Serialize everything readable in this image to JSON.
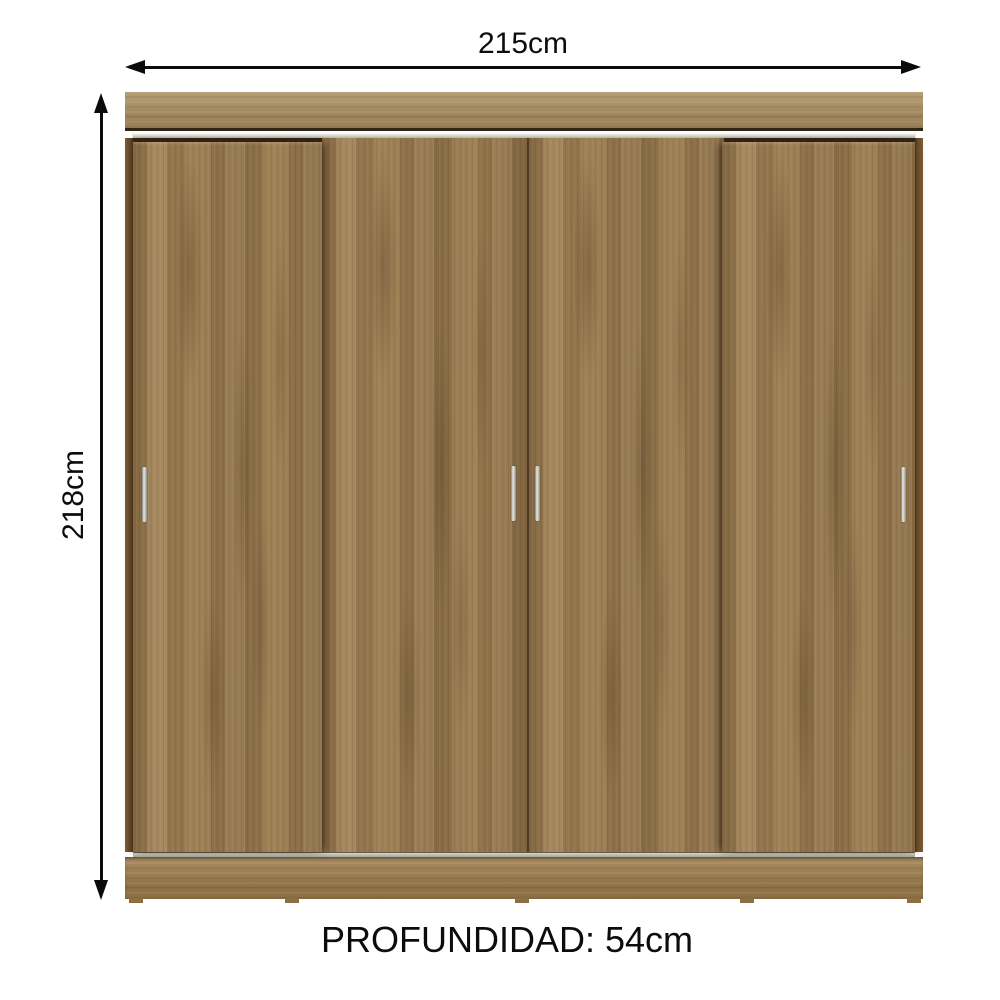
{
  "diagram": {
    "width": {
      "label": "215cm"
    },
    "height": {
      "label": "218cm"
    },
    "depth": {
      "label": "PROFUNDIDAD: 54cm"
    }
  },
  "product": {
    "name": "4-door sliding wardrobe",
    "door_count": 4,
    "colors": {
      "wood": "#9c7d51",
      "wood_top_panel": "#a88e62",
      "wood_dark_edge": "#6b4f2c",
      "rail_silver": "#d9d9cf",
      "handle_silver": "#c9c9c1",
      "dimension_line": "#0b0b0b",
      "background": "#ffffff"
    }
  }
}
